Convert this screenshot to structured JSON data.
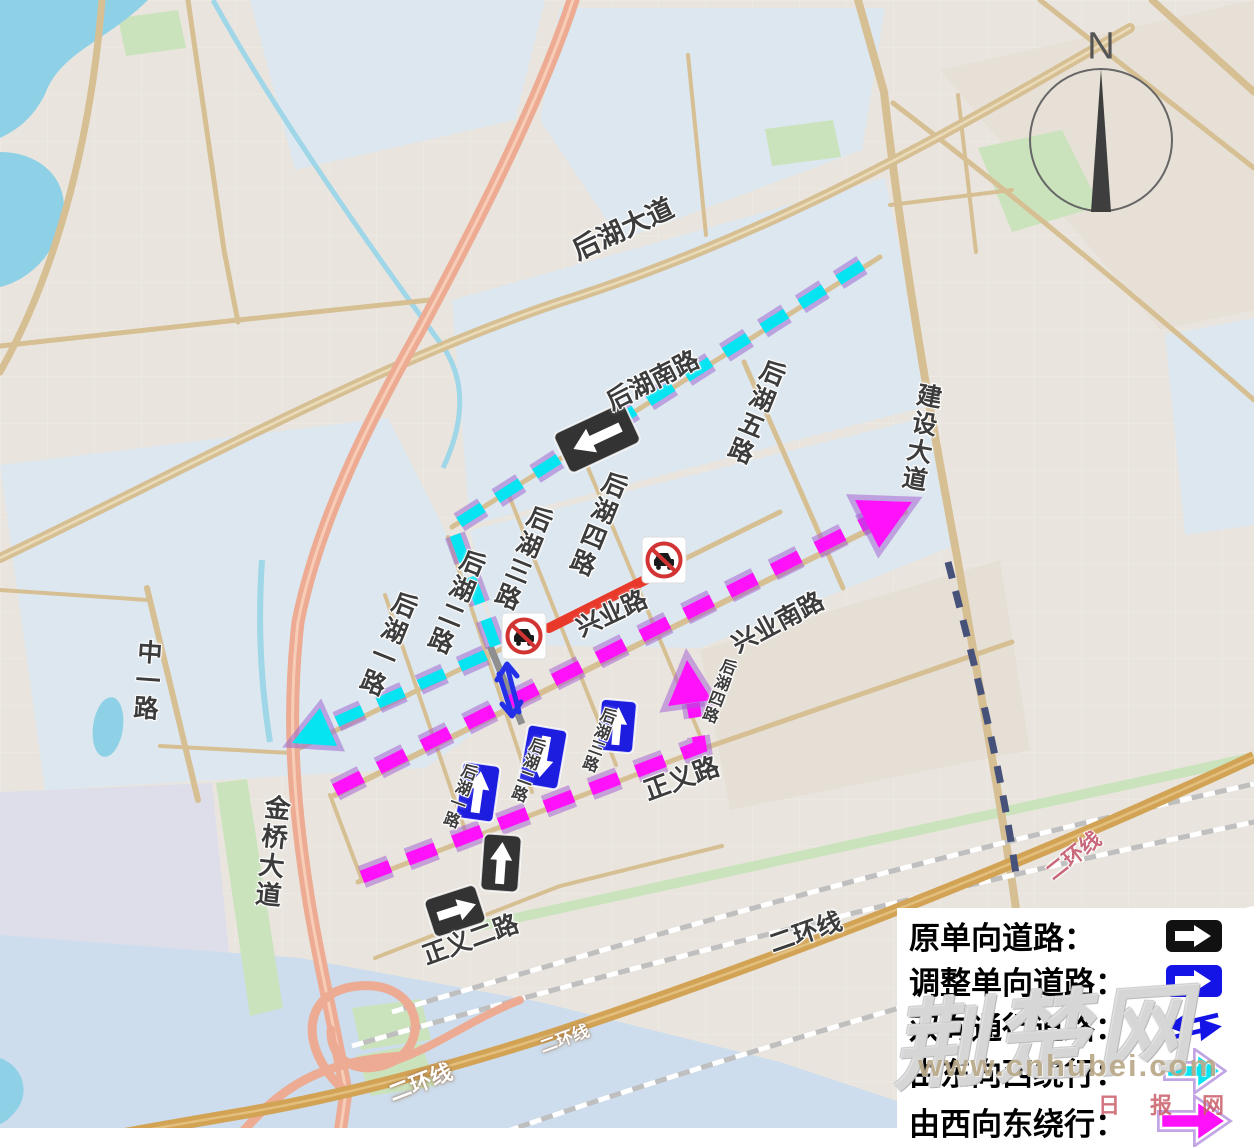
{
  "map": {
    "compass": "N",
    "labels": [
      {
        "text": "后湖大道"
      },
      {
        "text": "后湖南路"
      },
      {
        "text": "后湖五路"
      },
      {
        "text": "后湖四路"
      },
      {
        "text": "后湖三路"
      },
      {
        "text": "后湖二路"
      },
      {
        "text": "后湖一路"
      },
      {
        "text": "建设大道"
      },
      {
        "text": "中一路"
      },
      {
        "text": "金桥大道"
      },
      {
        "text": "兴业路"
      },
      {
        "text": "兴业南路"
      },
      {
        "text": "正义路"
      },
      {
        "text": "正义二路"
      },
      {
        "text": "后湖一路"
      },
      {
        "text": "后湖二路"
      },
      {
        "text": "后湖三路"
      },
      {
        "text": "后湖四路"
      },
      {
        "text": "二环线"
      },
      {
        "text": "二环线"
      },
      {
        "text": "二环线"
      },
      {
        "text": "二环线"
      }
    ]
  },
  "legend": {
    "rows": [
      {
        "label": "原单向道路：",
        "icon": "black-one-way-sign"
      },
      {
        "label": "调整单向道路：",
        "icon": "blue-one-way-sign"
      },
      {
        "label": "双向通行道路：",
        "icon": "two-way-arrows"
      },
      {
        "label": "由东向西绕行：",
        "icon": "cyan-detour-arrow"
      },
      {
        "label": "由西向东绕行：",
        "icon": "magenta-detour-arrow"
      }
    ]
  },
  "watermark": {
    "site_script": "荆楚网",
    "url": "www.cnhubei.com",
    "small_text": "日报网"
  },
  "colors": {
    "original_one_way_sign": "#333333",
    "adjusted_one_way_sign": "#1d1de0",
    "east_to_west_detour": "#06e4f2",
    "west_to_east_detour": "#ff12fa",
    "closed_section": "#e8392b"
  }
}
